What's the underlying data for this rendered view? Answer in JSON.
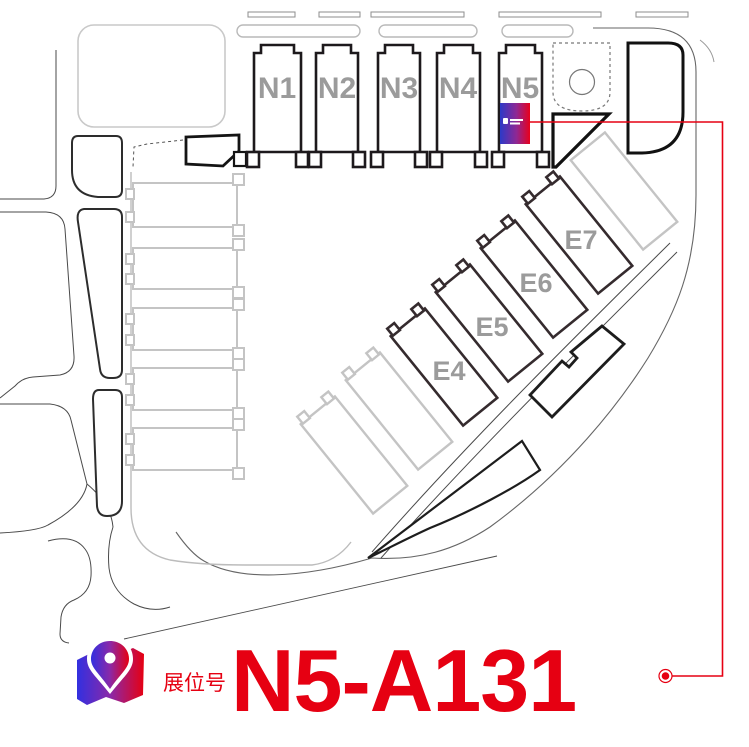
{
  "map": {
    "north_halls": [
      {
        "id": "N1"
      },
      {
        "id": "N2"
      },
      {
        "id": "N3"
      },
      {
        "id": "N4"
      },
      {
        "id": "N5"
      }
    ],
    "east_halls": [
      {
        "id": "E4"
      },
      {
        "id": "E5"
      },
      {
        "id": "E6"
      },
      {
        "id": "E7"
      }
    ],
    "booth": {
      "hall": "N5",
      "marker": "gradient-flag"
    }
  },
  "legend": {
    "label": "展位号",
    "booth_number": "N5-A131"
  },
  "colors": {
    "accent_red": "#e60012",
    "hall_outline": "#241d20",
    "hall_label_gray": "#9b9b9b",
    "map_gray": "#c4c4c4",
    "booth_blue": "#2c3ac8"
  }
}
